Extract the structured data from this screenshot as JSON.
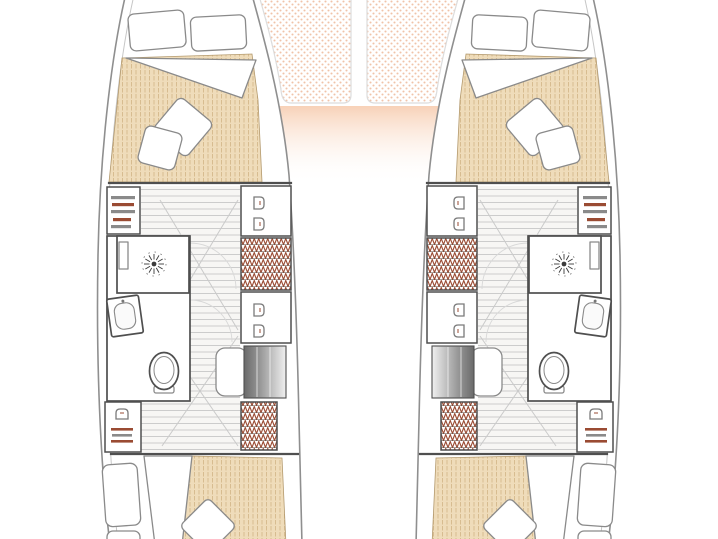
{
  "page": {
    "title": "Catamaran interior layout — floor plan"
  },
  "plan": {
    "type": "boat-floorplan",
    "vessel": "catamaran",
    "hulls": 2,
    "double_berth_cabins": 4,
    "bathrooms": 2,
    "toilets": 2,
    "shower_roses": 2,
    "bow_trampolines": 2,
    "companionway_steps": 2
  },
  "symbols": {
    "shower_rose": "sunburst-icon",
    "toilet": "oval-bowl-icon",
    "sink": "rounded-basin-icon",
    "hanging_locker": "zigzag-hatch",
    "shelf_locker": "horizontal-bars",
    "clothes_hooks": "u-hooks",
    "floorboards": "plank-stripes",
    "trampoline": "dot-mesh",
    "mattress": "pinstripe-fill"
  },
  "colors": {
    "hull-line": "#8f8f8f",
    "hull-line-light": "#c6c6c6",
    "wall": "#4f4f4f",
    "furn": "#8a8a8a",
    "mattress": "#efdcba",
    "mattress-line": "#d5b98c",
    "tramp-dot": "#f0c3a9",
    "deck": "#f6c9ab",
    "floor-line": "#cccccc",
    "steps-dark": "#6a6a6a",
    "hatch": "#9a4b33",
    "hatch-dark": "#5f4f46",
    "faint": "#d9d9d9",
    "background": "#ffffff"
  }
}
